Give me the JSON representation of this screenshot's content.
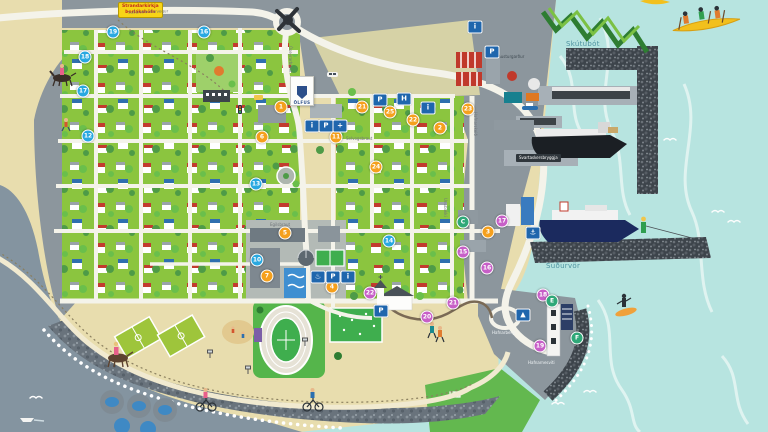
{
  "map": {
    "region_names": {
      "bay_northeast": "Skútubót",
      "bay_southeast": "Suðurvör",
      "pier": "Svartaskersbryggja",
      "breakwater_road": "Austurgarður",
      "lighthouse": "Hafnarnesviti",
      "road_top": "Suðurstrandarvegur",
      "street_oseyrarbraut": "Óseyrarbraut",
      "street_selvogsbraut": "Selvogsbraut",
      "street_egilsbraut": "Egilsbraut",
      "street_unubakki": "Unubakki",
      "street_hafnarskeid": "Hafnarskeið",
      "street_hafnarberg": "Hafnarberg"
    },
    "road_sign": {
      "line1": "Strandarkirkja",
      "line2": "Þorlákshöfn"
    },
    "banner": {
      "text": "ÖLFUS"
    },
    "markers": {
      "blue": [
        {
          "label": "19"
        },
        {
          "label": "16"
        },
        {
          "label": "18"
        },
        {
          "label": "17"
        },
        {
          "label": "12"
        },
        {
          "label": "13"
        },
        {
          "label": "10"
        },
        {
          "label": "14"
        }
      ],
      "orange": [
        {
          "label": "1"
        },
        {
          "label": "6"
        },
        {
          "label": "11"
        },
        {
          "label": "5"
        },
        {
          "label": "7"
        },
        {
          "label": "4"
        },
        {
          "label": "21"
        },
        {
          "label": "25"
        },
        {
          "label": "22"
        },
        {
          "label": "23"
        },
        {
          "label": "2"
        },
        {
          "label": "3"
        },
        {
          "label": "24"
        }
      ],
      "pink": [
        {
          "label": "15"
        },
        {
          "label": "16"
        },
        {
          "label": "17"
        },
        {
          "label": "18"
        },
        {
          "label": "19"
        },
        {
          "label": "20"
        },
        {
          "label": "21"
        },
        {
          "label": "22"
        }
      ],
      "green": [
        {
          "label": "C"
        },
        {
          "label": "E"
        },
        {
          "label": "F"
        }
      ]
    },
    "icons": [
      {
        "name": "info-icon",
        "glyph": "i"
      },
      {
        "name": "parking-icon",
        "glyph": "P"
      },
      {
        "name": "health-icon",
        "glyph": "+"
      },
      {
        "name": "parking-icon",
        "glyph": "P"
      },
      {
        "name": "hotel-icon",
        "glyph": "H"
      },
      {
        "name": "info-icon",
        "glyph": "i"
      },
      {
        "name": "pool-icon",
        "glyph": "♨"
      },
      {
        "name": "parking-icon",
        "glyph": "P"
      },
      {
        "name": "info-icon",
        "glyph": "i"
      },
      {
        "name": "info-icon",
        "glyph": "i"
      },
      {
        "name": "parking-icon",
        "glyph": "P"
      },
      {
        "name": "harbor-icon",
        "glyph": "⚓"
      },
      {
        "name": "viewpoint-icon",
        "glyph": "▲"
      },
      {
        "name": "parking-icon",
        "glyph": "P"
      }
    ],
    "colors": {
      "ocean": "#b7e4e0",
      "sea_gray": "#8494a0",
      "sand": "#e8ddae",
      "town_green": "#8bc53f",
      "land_gray": "#8c969d",
      "marker_blue": "#29a8e0",
      "marker_orange": "#f5a01d",
      "marker_pink": "#c75fc7",
      "marker_green": "#2fa878",
      "icon_blue": "#1f66ad"
    }
  }
}
